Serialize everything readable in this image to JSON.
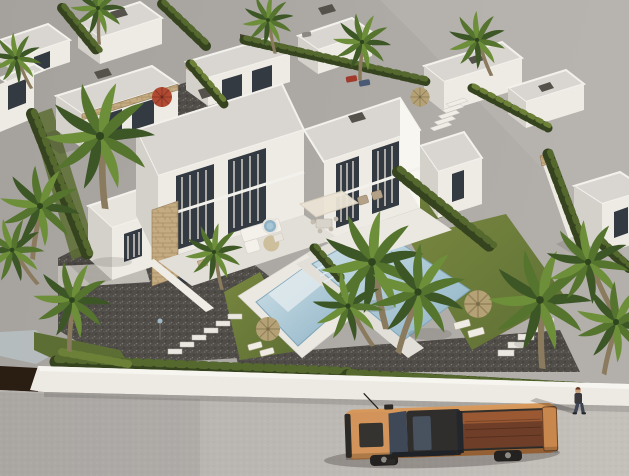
{
  "scene": {
    "kind": "aerial-3d-architectural-render",
    "setting": "modern white villa development with flat roofs, stone accents, pools, lawns, cypress hedges, palm trees, perimeter wall and street",
    "foreground_objects": [
      "orange pickup truck on road",
      "pedestrian walking on road",
      "white perimeter wall",
      "dark entrance gate"
    ],
    "garden_objects": [
      "two swimming pools with white decks",
      "straw parasols with sun loungers",
      "red parasol",
      "outdoor L-sofa",
      "pergola with dining set",
      "jacuzzi",
      "stepping stone paths",
      "gravel driveway",
      "garden lamp"
    ],
    "vehicles": {
      "pickup_truck_color": "#cf8e52",
      "small_cars": [
        "#a03a2c",
        "#4a5a74",
        "#8b8884"
      ]
    },
    "buildings": {
      "main": "two-story semi-detached villa pair with stone feature wall",
      "background": "rows of single-story white villas",
      "right": "detached villa behind hedge"
    }
  },
  "palette": {
    "roof": "#d9d6d1",
    "roofLight": "#e7e4de",
    "roofEdge": "#f3f1eb",
    "faceS": "#eeebe5",
    "faceW": "#d4d1cb",
    "faceE": "#f8f6f1",
    "win": "#343a41",
    "curtain": "#d9d5ce",
    "chimney": "#55524c",
    "deck": "#e2dfd8",
    "deckLight": "#ebe8e1",
    "stoneLine": "#8f7a58",
    "hedgeDark": "#35431f",
    "hedgeLight": "#55682e",
    "hedgeLight2": "#6c8038",
    "land1": "#a5a19d",
    "land2": "#b3afab",
    "road1": "#b4b0ac",
    "road2": "#c4c0ba",
    "wall": "#edeae3",
    "gate": "#2a1d12",
    "pool1": "#cfe1e8",
    "pool2": "#8fb3c6",
    "lawn1": "#78873f",
    "lawn2": "#5d6e34",
    "truck1": "#d89a5c",
    "truck2": "#b4743e",
    "truckBed": "#6f3e28",
    "truckCopper": "#a55f36",
    "straw": "#b5a176",
    "strawDark": "#93825a",
    "redParasol": "#b04a33",
    "trunk": "#8a7a5e",
    "frondDark": "#3c5626",
    "frondMid": "#55742e",
    "frondLight": "#6e8f3a",
    "skin": "#c99f7b",
    "shirt": "#3a3a3e",
    "jeans": "#3e4656"
  }
}
